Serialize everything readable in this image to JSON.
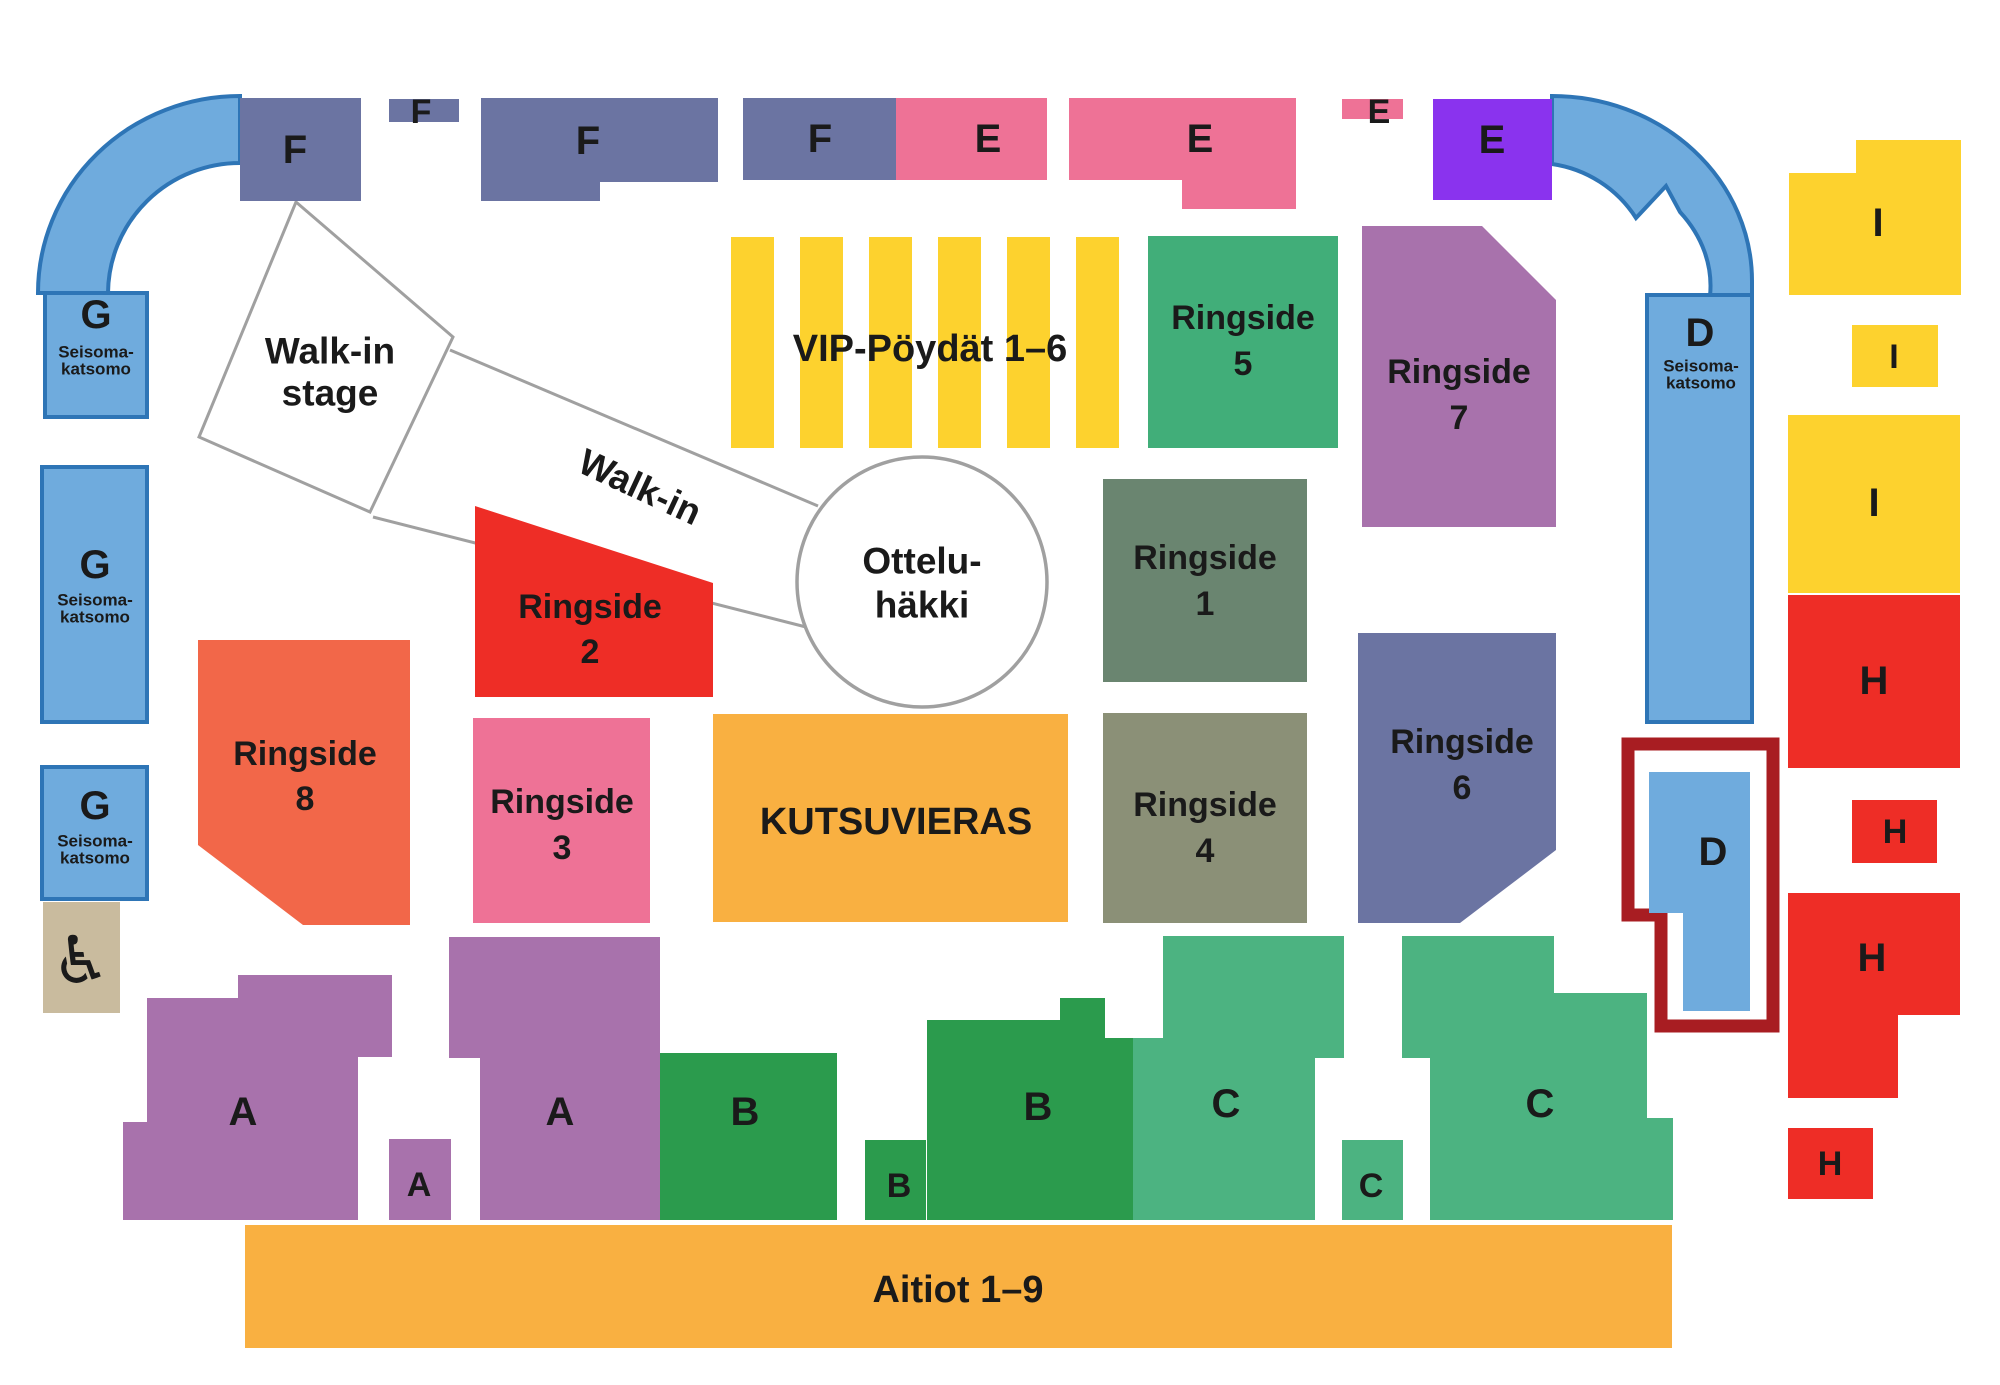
{
  "colors": {
    "blue": "#6FABDD",
    "blue_stroke": "#2E75B6",
    "slate": "#6B74A2",
    "pink": "#EE7296",
    "violet": "#8A33EE",
    "mauve": "#A872AC",
    "yellow": "#FDD22E",
    "green_mid": "#41AE79",
    "green_dark": "#2B9B4D",
    "green_light": "#4CB381",
    "sage": "#6A8570",
    "olive": "#8B9077",
    "red": "#EE2D26",
    "tomato": "#F26749",
    "orange": "#F9B041",
    "tan": "#C9BB9E",
    "highlight_red": "#A81D22",
    "outline_gray": "#A0A0A0",
    "text_gray": "#6D6E71",
    "black": "#1A1A1A",
    "white": "#FFFFFF"
  },
  "sections": {
    "stand_g1": {
      "letter": "G",
      "sub1": "Seisoma-",
      "sub2": "katsomo"
    },
    "stand_g2": {
      "letter": "G",
      "sub1": "Seisoma-",
      "sub2": "katsomo"
    },
    "stand_g3": {
      "letter": "G",
      "sub1": "Seisoma-",
      "sub2": "katsomo"
    },
    "stand_d_right": {
      "letter": "D",
      "sub1": "Seisoma-",
      "sub2": "katsomo"
    },
    "d_highlight": {
      "letter": "D"
    },
    "f1": {
      "letter": "F"
    },
    "f2": {
      "letter": "F"
    },
    "f3": {
      "letter": "F"
    },
    "f4": {
      "letter": "F"
    },
    "e1": {
      "letter": "E"
    },
    "e2": {
      "letter": "E"
    },
    "e3": {
      "letter": "E"
    },
    "e4": {
      "letter": "E"
    },
    "vip": {
      "label": "VIP-Pöydät 1–6"
    },
    "ringside1": {
      "name": "Ringside",
      "number": "1"
    },
    "ringside2": {
      "name": "Ringside",
      "number": "2"
    },
    "ringside3": {
      "name": "Ringside",
      "number": "3"
    },
    "ringside4": {
      "name": "Ringside",
      "number": "4"
    },
    "ringside5": {
      "name": "Ringside",
      "number": "5"
    },
    "ringside6": {
      "name": "Ringside",
      "number": "6"
    },
    "ringside7": {
      "name": "Ringside",
      "number": "7"
    },
    "ringside8": {
      "name": "Ringside",
      "number": "8"
    },
    "kutsuvieras": {
      "label": "KUTSUVIERAS"
    },
    "aitiot": {
      "label": "Aitiot 1–9"
    },
    "a_main": {
      "letter": "A"
    },
    "a_tab": {
      "letter": "A"
    },
    "a2": {
      "letter": "A"
    },
    "b1": {
      "letter": "B"
    },
    "b_tab": {
      "letter": "B"
    },
    "b2": {
      "letter": "B"
    },
    "c1": {
      "letter": "C"
    },
    "c_tab": {
      "letter": "C"
    },
    "c2": {
      "letter": "C"
    },
    "i1": {
      "letter": "I"
    },
    "i2": {
      "letter": "I"
    },
    "i3": {
      "letter": "I"
    },
    "h1": {
      "letter": "H"
    },
    "h2": {
      "letter": "H"
    },
    "h3": {
      "letter": "H"
    },
    "h4": {
      "letter": "H"
    },
    "stage": {
      "line1": "Walk-in",
      "line2": "stage"
    },
    "walkin_path": {
      "label": "Walk-in"
    },
    "cage": {
      "line1": "Ottelu-",
      "line2": "häkki"
    },
    "wheelchair": {
      "icon": "♿"
    }
  }
}
